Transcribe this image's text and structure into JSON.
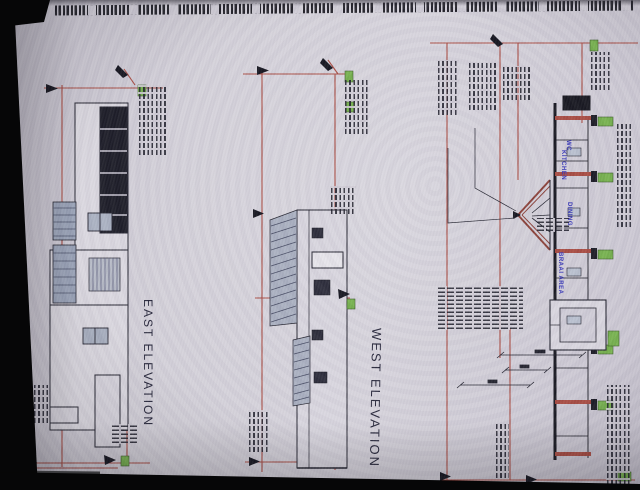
{
  "scene": {
    "kind": "photograph of printed architectural drawing sheet, rotated 90 degrees",
    "sheet_edge_text_legible": false,
    "annotation_notes_legible": false,
    "colors": {
      "photo_background": "#060607",
      "paper": "#d2ced8",
      "dimension_line_red": "#a84b42",
      "drawing_ink": "#20202c",
      "highlight_green": "#76b14e",
      "room_label_blue": "#3434b8",
      "window_hatch": "#9aa3b8"
    }
  },
  "drawings": {
    "east": {
      "label": "EAST ELEVATION"
    },
    "west": {
      "label": "WEST ELEVATION"
    },
    "section": {
      "rooms": [
        {
          "label": "WC"
        },
        {
          "label": "KITCHEN"
        },
        {
          "label": "DINING"
        },
        {
          "label": "BRAAI AREA"
        }
      ]
    }
  }
}
